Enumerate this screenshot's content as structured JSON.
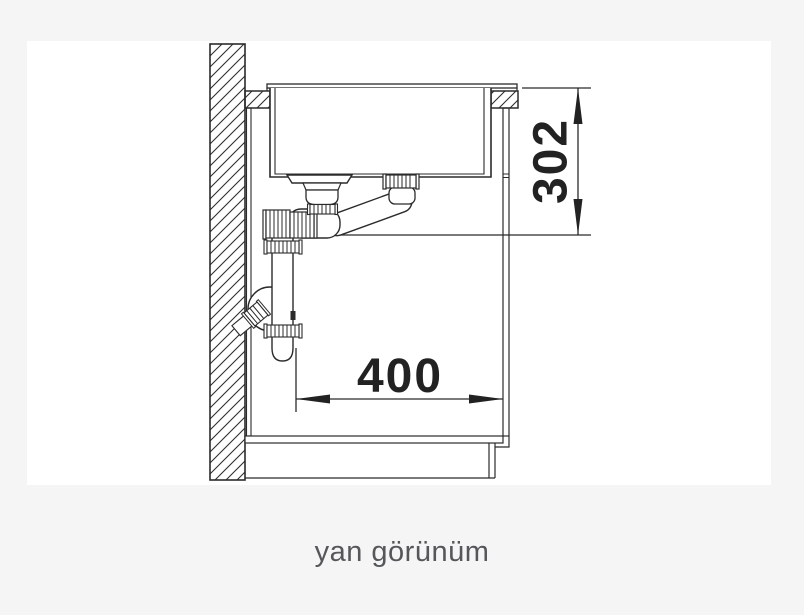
{
  "page": {
    "background": "#f5f5f6",
    "card_background": "#ffffff"
  },
  "diagram": {
    "line_color": "#2b2b2b",
    "dimension_text_color": "#222222",
    "dimensions": [
      {
        "label": "302",
        "orientation": "vertical"
      },
      {
        "label": "400",
        "orientation": "horizontal"
      }
    ],
    "caption": {
      "text": "yan görünüm",
      "color": "#55575a"
    }
  }
}
